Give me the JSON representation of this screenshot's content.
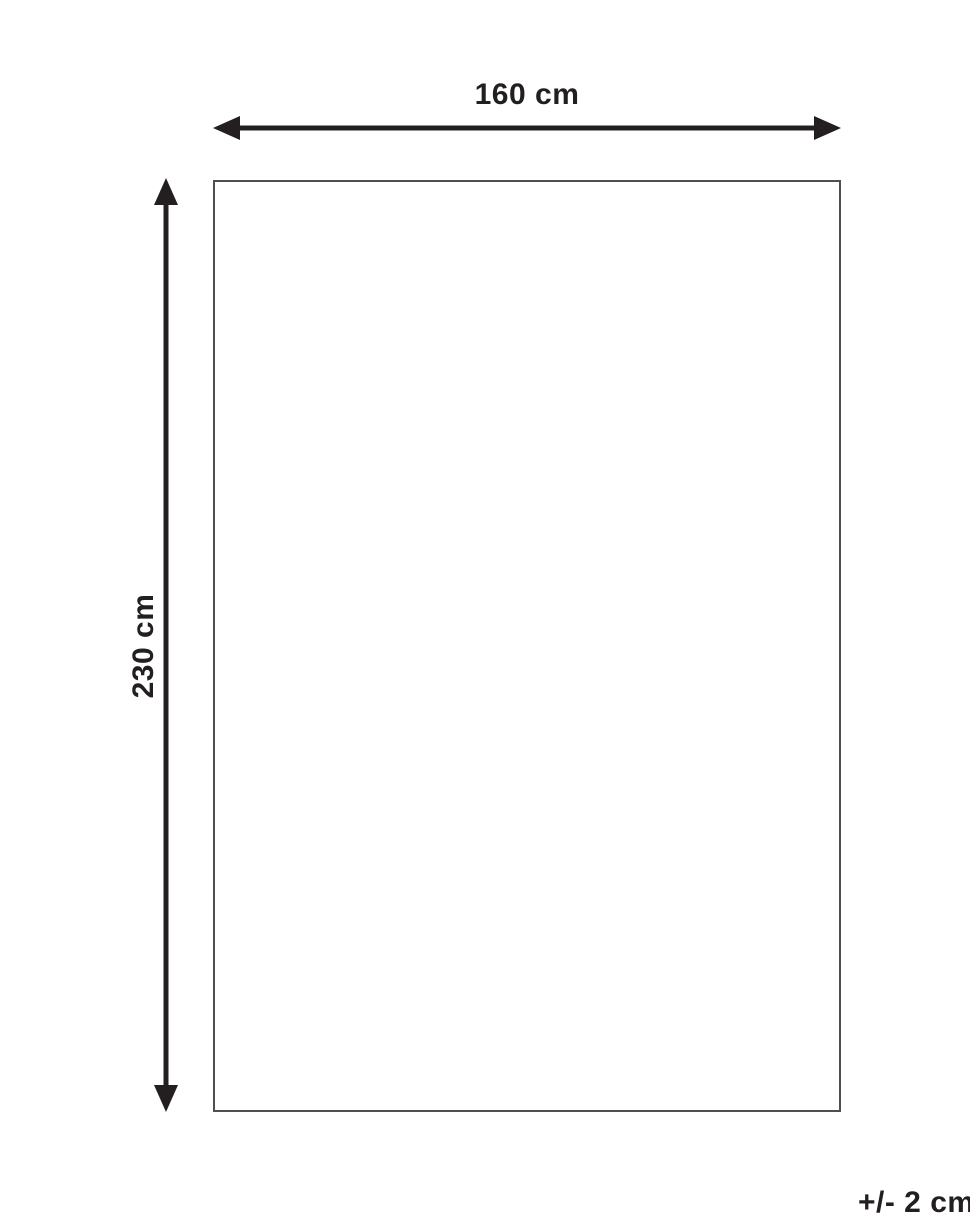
{
  "diagram": {
    "width_label": "160 cm",
    "height_label": "230 cm",
    "tolerance_label": "+/- 2 cm",
    "dimensions": {
      "width_cm": 160,
      "height_cm": 230,
      "tolerance_cm": 2
    },
    "colors": {
      "arrow": "#231f20",
      "text": "#231f20",
      "outline": "#4f4f51",
      "background": "#ffffff"
    }
  }
}
